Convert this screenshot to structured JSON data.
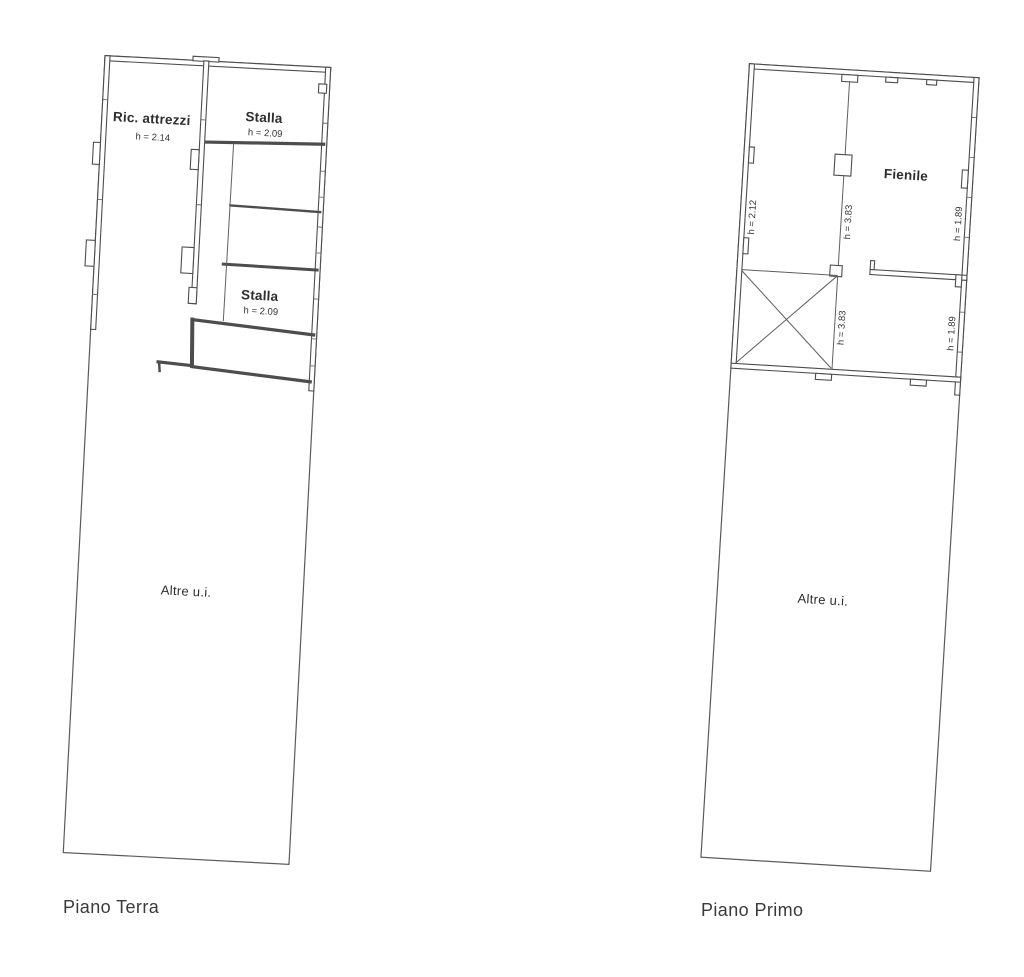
{
  "document": {
    "background_color": "#ffffff",
    "line_color": "#4d4d4d",
    "text_color": "#2e2e2e"
  },
  "floor_plans": [
    {
      "title": "Piano Terra",
      "rooms": [
        {
          "name": "Ric. attrezzi",
          "height_label": "h = 2.14"
        },
        {
          "name": "Stalla",
          "height_label": "h = 2.09"
        },
        {
          "name": "Stalla",
          "height_label": "h = 2.09"
        },
        {
          "name": "Altre u.i."
        }
      ]
    },
    {
      "title": "Piano Primo",
      "rooms": [
        {
          "name": "Fienile"
        },
        {
          "name": "Altre u.i."
        }
      ],
      "height_labels": [
        "h = 2.12",
        "h = 3.83",
        "h = 1.89",
        "h = 3.83",
        "h = 1.89"
      ]
    }
  ]
}
